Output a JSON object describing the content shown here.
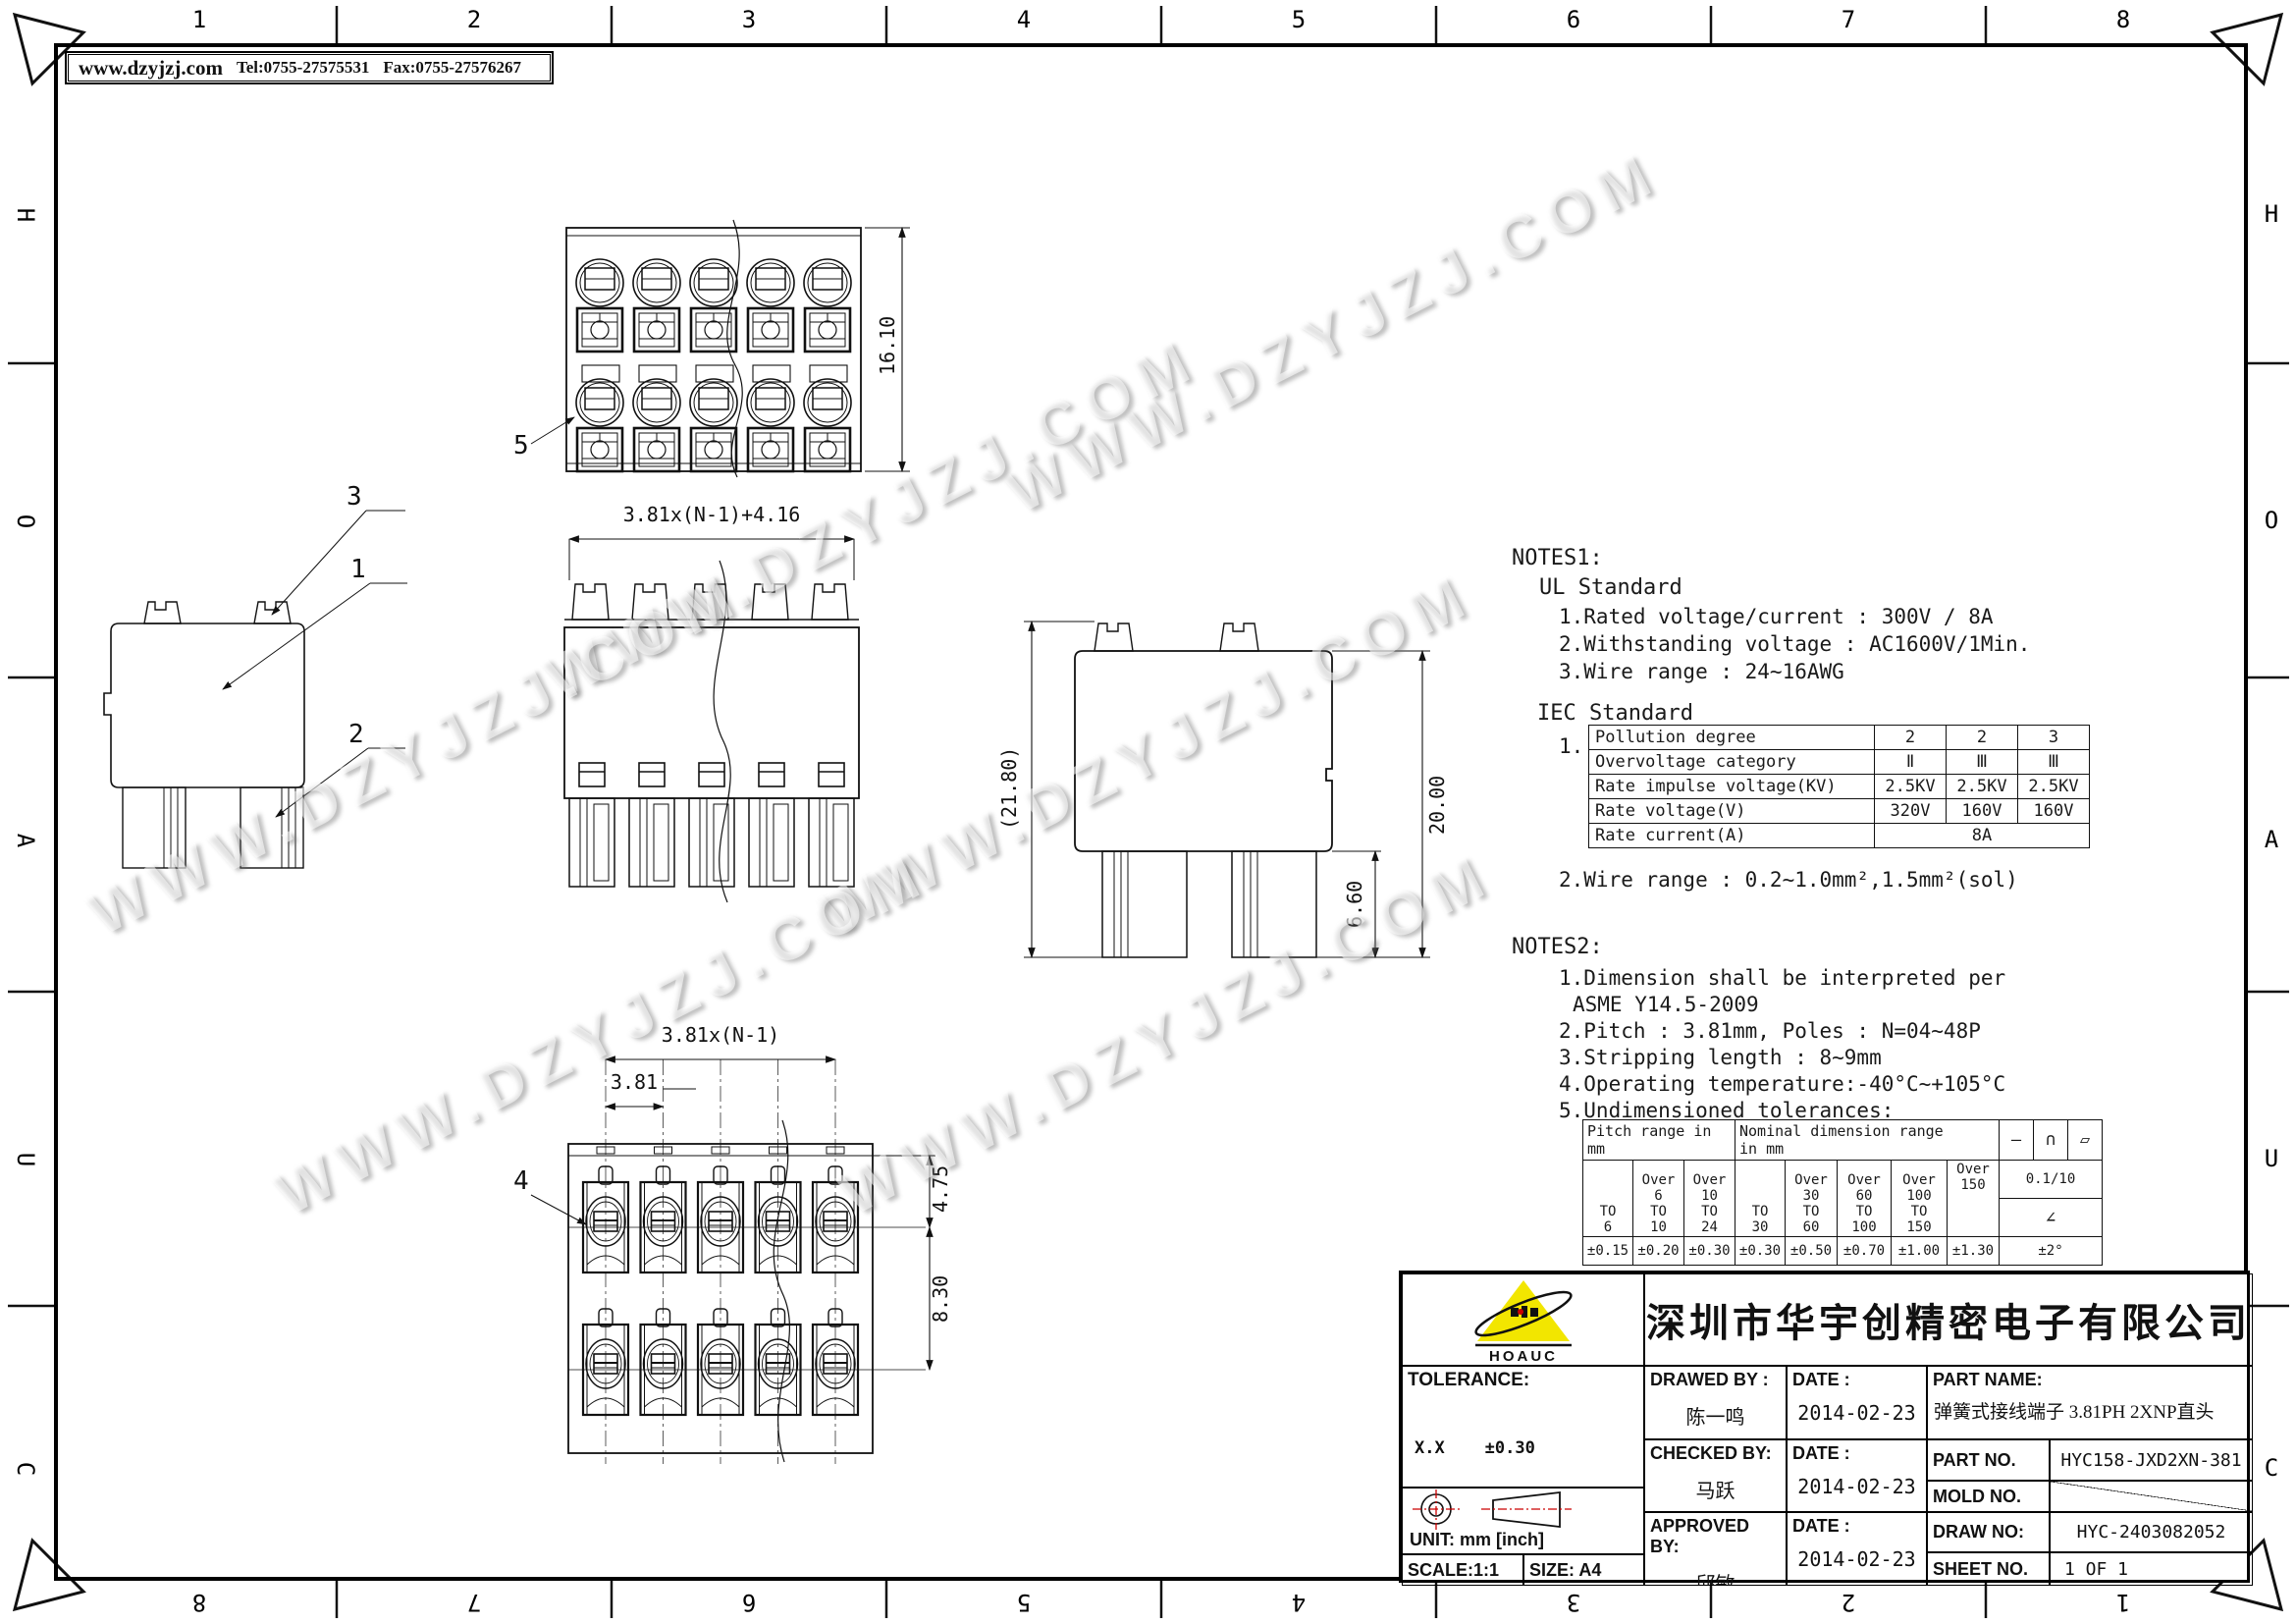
{
  "sheet": {
    "watermark": "WWW.DZYJZJ.COM",
    "info_bar": {
      "site": "www.dzyjzj.com",
      "tel": "Tel:0755-27575531",
      "fax": "Fax:0755-27576267"
    },
    "zones": {
      "top": [
        "1",
        "2",
        "3",
        "4",
        "5",
        "6",
        "7",
        "8"
      ],
      "bottom": [
        "8",
        "7",
        "6",
        "5",
        "4",
        "3",
        "2",
        "1"
      ],
      "left": [
        "H",
        "O",
        "A",
        "U",
        "C"
      ],
      "right": [
        "H",
        "O",
        "A",
        "U",
        "C"
      ]
    }
  },
  "views": {
    "top": {
      "dim_height": "16.10",
      "balloon": "5"
    },
    "front": {
      "dim_width": "3.81x(N-1)+4.16"
    },
    "side_left": {
      "balloon_3": "3",
      "balloon_1": "1",
      "balloon_2": "2"
    },
    "side_right": {
      "dim_total": "(21.80)",
      "dim_body": "20.00",
      "dim_leg": "6.60"
    },
    "bottom": {
      "dim_span": "3.81x(N-1)",
      "dim_pitch": "3.81",
      "dim_top": "4.75",
      "dim_row": "8.30",
      "balloon": "4"
    }
  },
  "notes1": {
    "title": "NOTES1:",
    "subtitle": "UL Standard",
    "items": [
      "1.Rated voltage/current : 300V / 8A",
      "2.Withstanding voltage : AC1600V/1Min.",
      "3.Wire range : 24~16AWG"
    ],
    "iec_title": "IEC Standard",
    "iec_item_no": "1.",
    "wire_range": "2.Wire range : 0.2~1.0mm²,1.5mm²(sol)"
  },
  "iec_table": {
    "rows": [
      {
        "label": "Pollution degree",
        "values": [
          "2",
          "2",
          "3"
        ]
      },
      {
        "label": "Overvoltage category",
        "values": [
          "Ⅱ",
          "Ⅲ",
          "Ⅲ"
        ]
      },
      {
        "label": "Rate impulse voltage(KV)",
        "values": [
          "2.5KV",
          "2.5KV",
          "2.5KV"
        ]
      },
      {
        "label": "Rate voltage(V)",
        "values": [
          "320V",
          "160V",
          "160V"
        ]
      },
      {
        "label": "Rate current(A)",
        "values": [
          "8A"
        ]
      }
    ]
  },
  "notes2": {
    "title": "NOTES2:",
    "items": [
      "1.Dimension shall be interpreted per",
      "ASME Y14.5-2009",
      "2.Pitch : 3.81mm, Poles : N=04~48P",
      "3.Stripping length : 8~9mm",
      "4.Operating temperature:-40°C~+105°C",
      "5.Undimensioned tolerances:"
    ]
  },
  "tol_table": {
    "header_pitch": "Pitch range in\nmm",
    "header_nominal": "Nominal dimension range\nin mm",
    "symbols": [
      "—",
      "∩",
      "▱"
    ],
    "ranges": [
      "TO\n6",
      "Over\n6\nTO\n10",
      "Over\n10\nTO\n24",
      "TO\n30",
      "Over\n30\nTO\n60",
      "Over\n60\nTO\n100",
      "Over\n100\nTO\n150",
      "Over 150"
    ],
    "flatness": "0.1/10",
    "angle_symbol": "∠",
    "tolerances": [
      "±0.15",
      "±0.20",
      "±0.30",
      "±0.30",
      "±0.50",
      "±0.70",
      "±1.00",
      "±1.30"
    ],
    "angle_tol": "±2°"
  },
  "title_block": {
    "logo_text": "HOAUC",
    "logo_color": "#f2e600",
    "accent_red": "#cc0000",
    "company": "深圳市华宇创精密电子有限公司",
    "tolerance_title": "TOLERANCE:",
    "tol_lines": [
      "X.X    ±0.30",
      "X.XX   ±0.25",
      "X.XXX  ±0.15"
    ],
    "tol_angle_line": "X.° ±2°     X.X° ±0.5°",
    "unit": "UNIT:  mm  [inch]",
    "scale": "SCALE:1:1",
    "size": "SIZE:  A4",
    "drawed_by_label": "DRAWED BY :",
    "drawed_by": "陈一鸣",
    "checked_by_label": "CHECKED BY:",
    "checked_by": "马跃",
    "approved_by_label": "APPROVED BY:",
    "approved_by": "邱敏",
    "date_label": "DATE :",
    "date_drawed": "2014-02-23",
    "date_checked": "2014-02-23",
    "date_approved": "2014-02-23",
    "part_name_label": "PART NAME:",
    "part_name": "弹簧式接线端子 3.81PH 2XNP直头",
    "part_no_label": "PART NO.",
    "part_no": "HYC158-JXD2XN-381",
    "mold_no_label": "MOLD NO.",
    "draw_no_label": "DRAW NO:",
    "draw_no": "HYC-2403082052",
    "sheet_no_label": "SHEET NO.",
    "sheet_no": "1 OF 1"
  }
}
